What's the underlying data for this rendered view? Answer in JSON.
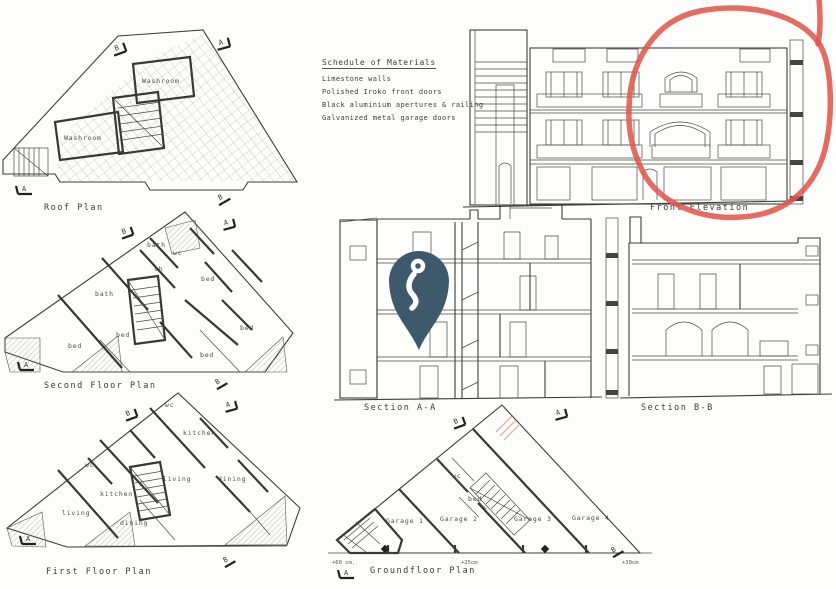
{
  "document": {
    "type": "architectural-drawing-sheet",
    "paper_color": "#fdfdfc",
    "line_color": "#3d3d3d"
  },
  "schedule": {
    "title": "Schedule of Materials",
    "items": [
      "Limestone walls",
      "Polished Iroko front doors",
      "Black aluminium apertures & railing",
      "Galvanized metal garage doors"
    ]
  },
  "markers": {
    "a": "A",
    "b": "B"
  },
  "plans": {
    "roof": {
      "caption": "Roof Plan",
      "labels": {
        "washroom_top": "Washroom",
        "washroom_left": "Washroom"
      }
    },
    "second": {
      "caption": "Second Floor Plan",
      "labels": {
        "bath_top": "bath",
        "wc": "wc",
        "sh": "sh",
        "bath_left": "bath",
        "bed_1": "bed",
        "bed_2": "bed",
        "bed_3": "bed",
        "bed_4": "bed",
        "bed_5": "bed"
      }
    },
    "first": {
      "caption": "First Floor Plan",
      "labels": {
        "wc_top": "wc",
        "wc_left": "wc",
        "kitchen_right": "kitchen",
        "kitchen_left": "kitchen",
        "living_right": "living",
        "living_left": "living",
        "dining_right": "dining",
        "dining_left": "dining"
      }
    },
    "ground": {
      "caption": "Groundfloor Plan",
      "labels": {
        "wc": "wc",
        "bed": "bed",
        "garage1": "Garage 1",
        "garage2": "Garage 2",
        "garage3": "Garage 3",
        "garage4": "Garage 4"
      },
      "levels": {
        "left": "+60 cm.",
        "mid": "+25cm",
        "right": "+30cm"
      }
    }
  },
  "views": {
    "front_elevation": {
      "caption": "Front Elevation"
    },
    "section_aa": {
      "caption": "Section  A-A"
    },
    "section_bb": {
      "caption": "Section  B-B"
    }
  },
  "annotations": {
    "red_circle": {
      "color": "#e0584a",
      "marks": "right wing of front elevation"
    },
    "map_pin": {
      "color": "#3e596b",
      "glyph_color": "#ffffff"
    },
    "red_pencil_mark": {
      "color": "#dd9288"
    }
  }
}
